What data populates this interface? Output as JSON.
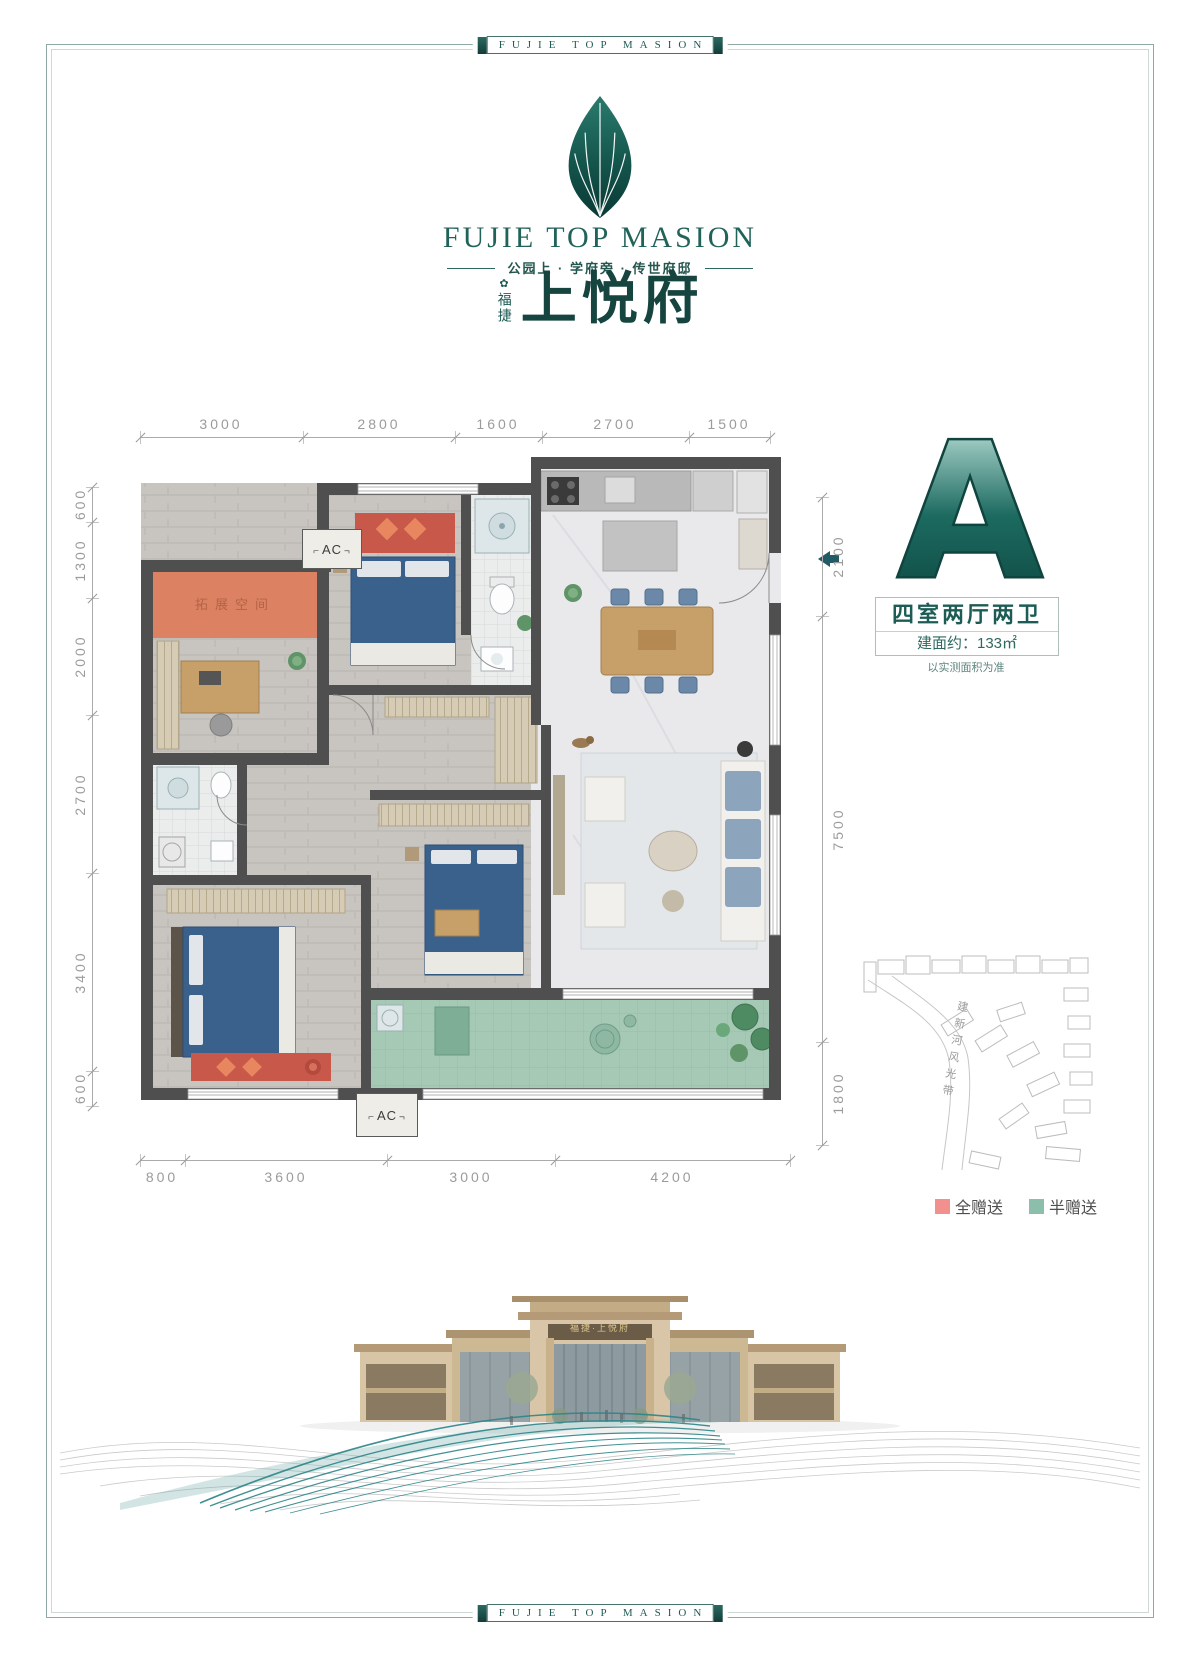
{
  "frame": {
    "label": "FUJIE TOP MASION"
  },
  "logo": {
    "brand_en": "FUJIE TOP MASION",
    "tagline": "公园上 · 学府旁 · 传世府邸",
    "seal_glyph": "✿",
    "brand_cn_prefix": "福捷",
    "brand_cn": "上悦府"
  },
  "unit": {
    "block_letter": "A",
    "layout_type": "四室两厅两卫",
    "area": "建面约：133㎡",
    "disclaimer": "以实测面积为准"
  },
  "floor_plan": {
    "expansion_label": "拓展空间",
    "ac_label": "AC",
    "dims_top": [
      "3000",
      "2800",
      "1600",
      "2700",
      "1500"
    ],
    "dims_left": [
      "600",
      "1300",
      "2000",
      "2700",
      "3400",
      "600"
    ],
    "dims_right": [
      "2100",
      "7500",
      "1800"
    ],
    "dims_bottom": [
      "800",
      "3600",
      "3000",
      "4200"
    ]
  },
  "site_plan": {
    "river_label": "建新河风光带"
  },
  "legend": {
    "full_gift": {
      "label": "全赠送",
      "color": "#f2908d"
    },
    "half_gift": {
      "label": "半赠送",
      "color": "#8cbfab"
    }
  },
  "rendering": {
    "sign": "福捷·上悦府"
  },
  "colors": {
    "brand_teal": "#1d5c55",
    "wall_gray": "#4f4f4f",
    "dim_gray": "#9b9b9b",
    "expansion_orange": "#dc8262",
    "balcony_green": "#a6c9b6",
    "bed_blue": "#3a618c",
    "accent_red": "#c7584a"
  }
}
